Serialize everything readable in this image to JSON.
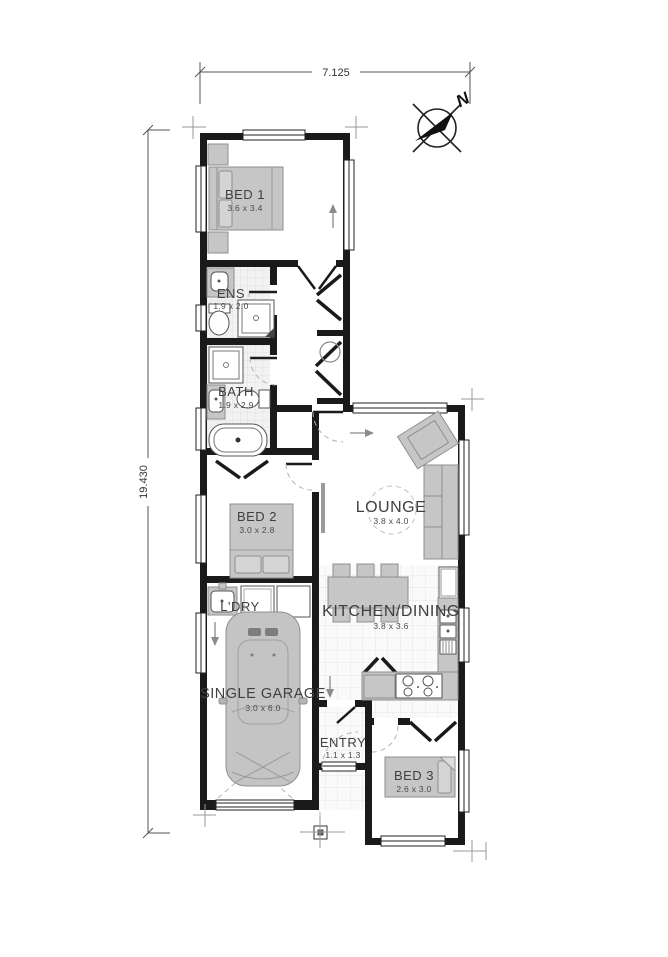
{
  "plan": {
    "overall_width": "7.125",
    "overall_depth": "19.430",
    "compass_label": "N"
  },
  "rooms": {
    "bed1": {
      "name": "BED 1",
      "size": "3.6 x 3.4"
    },
    "ens": {
      "name": "ENS",
      "size": "1.9 x 2.0"
    },
    "bath": {
      "name": "BATH",
      "size": "1.9 x 2.9"
    },
    "bed2": {
      "name": "BED 2",
      "size": "3.0 x 2.8"
    },
    "lounge": {
      "name": "LOUNGE",
      "size": "3.8 x 4.0"
    },
    "kitchen": {
      "name": "KITCHEN/DINING",
      "size": "3.8 x 3.6"
    },
    "laundry": {
      "name": "L'DRY"
    },
    "garage": {
      "name": "SINGLE GARAGE",
      "size": "3.0 x 6.0"
    },
    "entry": {
      "name": "ENTRY",
      "size": "1.1 x 1.3"
    },
    "bed3": {
      "name": "BED 3",
      "size": "2.6 x 3.0"
    }
  },
  "colors": {
    "wall": "#1a1a1a",
    "furniture": "#c6c6c6",
    "furniture_stroke": "#8f8f8f",
    "tile_line": "#dddddd",
    "label_text": "#3f3f3f",
    "door_swing": "#b3b3b3"
  }
}
